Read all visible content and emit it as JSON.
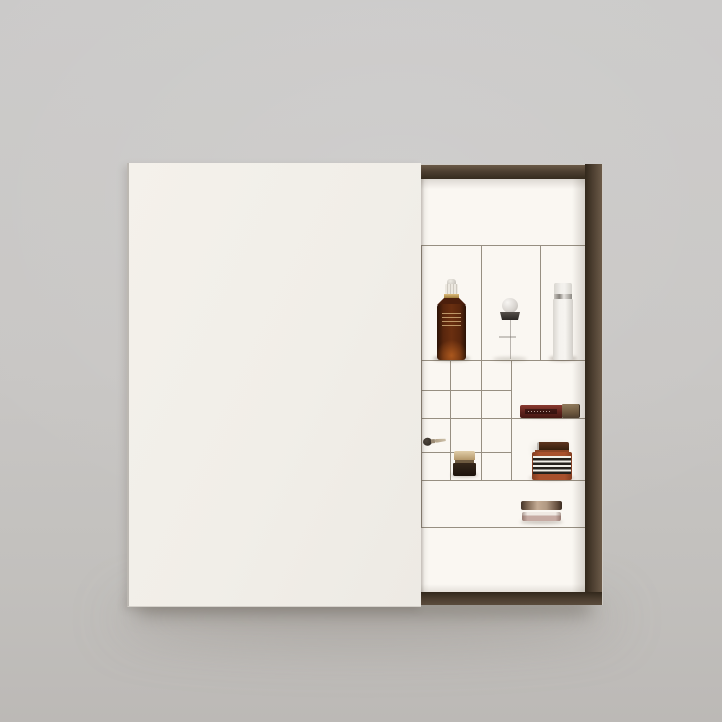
{
  "scene": {
    "type": "product-photograph",
    "description": "Overhead studio photo of a white beauty advent-calendar box with a dark walnut-framed tray; the white lid is slid over the left two-thirds, revealing a right column of white compartments holding miniature cosmetics.",
    "background": "plain light-gray studio backdrop with soft drop shadow under the box"
  },
  "palette": {
    "bg-top": "#cbcac9",
    "bg-bottom": "#bcb9b6",
    "lid": "#f2efe9",
    "frame-light": "#6b5a48",
    "frame-mid": "#4c3e30",
    "frame-dark": "#32281c",
    "interior": "#faf7f2",
    "line": "#978f82"
  },
  "box": {
    "lid_state": "slid left, covering about two thirds of the tray",
    "frame_material": "dark brown wood frame",
    "visible_sections": [
      "empty top shelf",
      "row of three tall product compartments",
      "grid of twelve small square cubbies (left) beside two medium compartments (right)",
      "full-width low shelf with compact",
      "empty bottom shelf"
    ],
    "small_grid": {
      "columns": 3,
      "rows": 4
    }
  },
  "products": [
    {
      "id": "serum-bottle",
      "name": "amber dropper serum bottle",
      "colors": [
        "#54230c",
        "#c7a96c",
        "#ece8e0"
      ],
      "slot": "top row, left compartment"
    },
    {
      "id": "perfume-bottle",
      "name": "transparent perfume bottle with frosted sphere cap",
      "colors": [
        "#d7d3ce",
        "#2b2724"
      ],
      "slot": "top row, middle compartment"
    },
    {
      "id": "pump-bottle",
      "name": "white cylindrical pump bottle with silver band",
      "colors": [
        "#f2f0ec",
        "#8d8983"
      ],
      "slot": "top row, right compartment"
    },
    {
      "id": "lip-gloss",
      "name": "liquid lip color lying on its side, dark red body with bronze cap",
      "colors": [
        "#5e231c",
        "#6e593f"
      ],
      "slot": "right medium compartment, upper"
    },
    {
      "id": "mini-brush",
      "name": "tiny makeup brush",
      "colors": [
        "#2c2620",
        "#ccbfa8"
      ],
      "slot": "small cubby, third row left"
    },
    {
      "id": "mini-jar",
      "name": "small cream jar with champagne lid and dark glass base",
      "colors": [
        "#b4976a",
        "#1c130c"
      ],
      "slot": "small cubby, bottom row middle"
    },
    {
      "id": "striped-jar",
      "name": "rust amber jar with black-and-white striped label and dark lid",
      "colors": [
        "#a8502c",
        "#f1eee7",
        "#25211c"
      ],
      "slot": "right medium compartment, lower"
    },
    {
      "id": "compact-duo",
      "name": "two stacked compacts seen edge-on, bronze over rose",
      "colors": [
        "#b19983",
        "#c6aba3"
      ],
      "slot": "full-width low shelf"
    }
  ]
}
